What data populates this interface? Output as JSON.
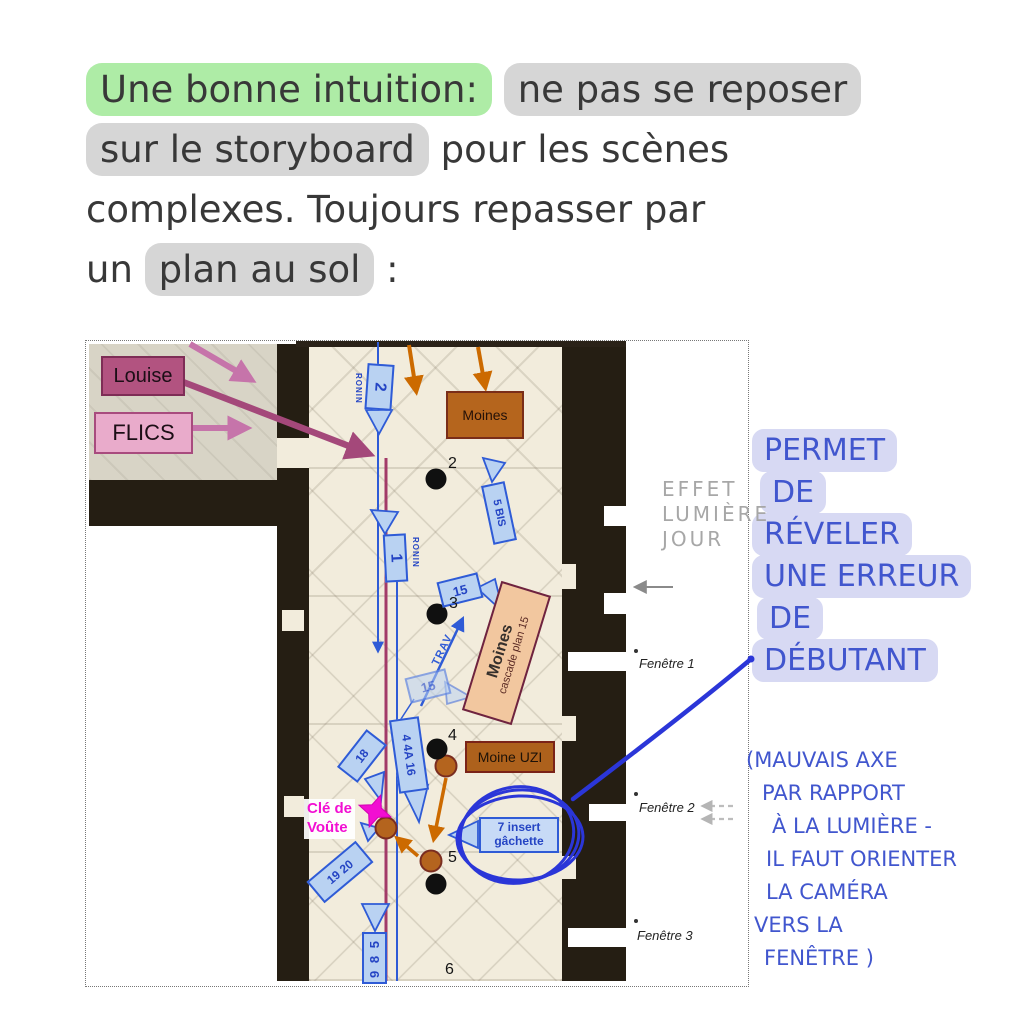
{
  "header": {
    "line1_green": "Une bonne intuition:",
    "line1_gray": "ne pas se reposer",
    "line2_gray": "sur le storyboard",
    "line2_rest": "pour les scènes",
    "line3": "complexes. Toujours repasser par",
    "line4_prefix": "un",
    "line4_gray": "plan au sol",
    "line4_suffix": ":"
  },
  "plan": {
    "louise": "Louise",
    "flics": "FLICS",
    "moines": "Moines",
    "cascade_title": "Moines",
    "cascade_sub": "cascade plan 15",
    "moine_uzi": "Moine UZI",
    "cam2": "2",
    "cam2_rig": "RONIN",
    "cam1": "1",
    "cam1_rig": "RONIN",
    "cam5bis": "5 BIS",
    "cam15": "15",
    "cam15b": "15",
    "trav": "TRAV",
    "cam4": "4 4A 16",
    "cam18": "18",
    "cam1920": "19 20",
    "cam589": "9 8 5",
    "cam7_line1": "7 insert",
    "cam7_line2": "gâchette",
    "cle_line1": "Clé de",
    "cle_line2": "Voûte",
    "pos2": "2",
    "pos3": "3",
    "pos4": "4",
    "pos5": "5",
    "pos6": "6",
    "effet_line1": "EFFET",
    "effet_line2": "LUMIÈRE",
    "effet_line3": "JOUR",
    "fenetre1": "Fenêtre 1",
    "fenetre2": "Fenêtre 2",
    "fenetre3": "Fenêtre 3"
  },
  "annotation": {
    "main_lines": [
      "PERMET",
      "DE",
      "RÉVELER",
      "UNE ERREUR",
      "DE",
      "DÉBUTANT"
    ],
    "sub_lines": [
      "(MAUVAIS AXE",
      "PAR RAPPORT",
      "À LA LUMIÈRE -",
      "IL FAUT ORIENTER",
      "LA CAMÉRA",
      "VERS LA",
      "FENÊTRE )"
    ]
  },
  "colors": {
    "highlight_green": "#aeeca6",
    "highlight_gray": "#d6d6d6",
    "highlight_lavender": "#d7d9f3",
    "ink_blue": "#4156ce",
    "pen_blue": "#2b36d8",
    "camera_blue": "#2f5bd6",
    "camera_fill": "#b9d2f2",
    "track_maroon": "#a23a68",
    "orange": "#cc6a00",
    "monk_brown": "#b5651d",
    "magenta": "#f20ed2",
    "louise_pink": "#b25380",
    "flics_pink": "#e9abcb"
  }
}
